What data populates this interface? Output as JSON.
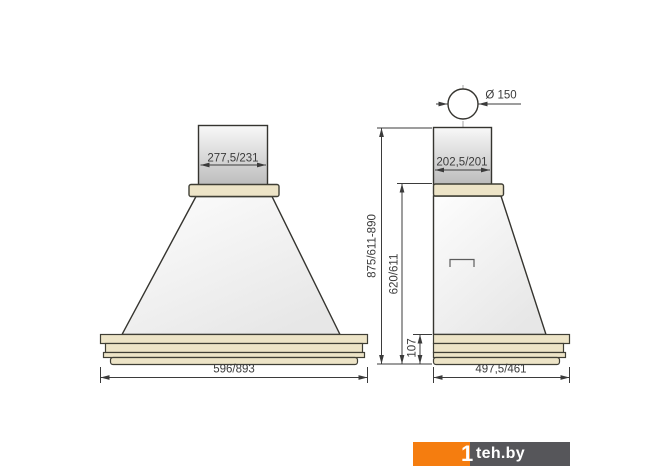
{
  "drawing": {
    "front_view": {
      "chimney_width": "277,5/231",
      "overall_width": "596/893"
    },
    "side_view": {
      "flue_diameter": "Ø 150",
      "chimney_depth": "202,5/201",
      "overall_height": "875/611-890",
      "body_height": "620/611",
      "cornice_height": "107",
      "overall_depth": "497,5/461"
    }
  },
  "watermark": {
    "prefix": "1",
    "name": "teh.by"
  },
  "colors": {
    "line": "#35342f",
    "dimension": "#3b3b3b",
    "beige": "#ede4c7",
    "logo_orange": "#f57d0f",
    "logo_gray": "#56565a"
  }
}
